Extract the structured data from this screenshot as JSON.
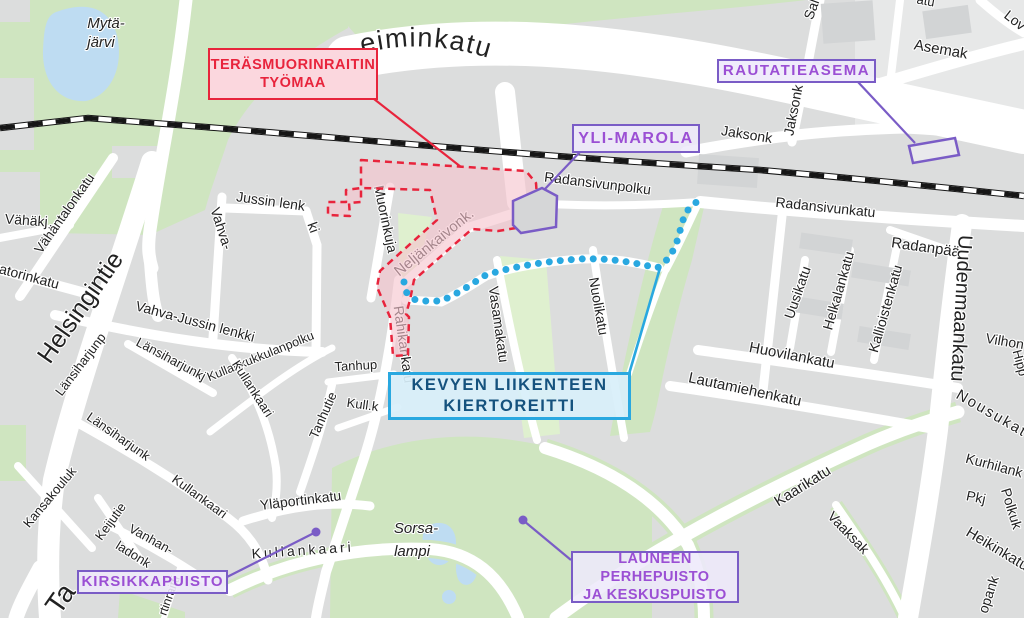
{
  "main_road_label": "Mannerheiminkatu",
  "annotations": {
    "work_area": {
      "lines": [
        "TERÄSMUORINRAITIN",
        "TYÖMAA"
      ],
      "color": "#e8243c"
    },
    "detour": {
      "lines": [
        "KEVYEN LIIKENTEEN",
        "KIERTOREITTI"
      ],
      "border": "#29a8e0",
      "text_color": "#15527e"
    },
    "rautatieasema": {
      "label": "RAUTATIEASEMA"
    },
    "yli_marola": {
      "label": "YLI-MAROLA"
    },
    "kirsikkapuisto": {
      "label": "KIRSIKKAPUISTO"
    },
    "launeen": {
      "lines": [
        "LAUNEEN PERHEPUISTO",
        "JA KESKUSPUISTO"
      ]
    },
    "purple": "#7a5cc6",
    "purple_text": "#9b4fd4"
  },
  "colors": {
    "block_gray": "#dcdddd",
    "road_white": "#ffffff",
    "park_green": "#cfe5c0",
    "verge_green": "#dff0cf",
    "water_blue": "#bedcf2",
    "railway_black": "#161616",
    "work_area_fill": "#f6c3cd",
    "route_cyan": "#29a8e0"
  },
  "map_labels": [
    {
      "t": "Mytä-",
      "x": 106,
      "y": 28,
      "r": 0,
      "s": 15,
      "i": 1,
      "c": "#3f464d"
    },
    {
      "t": "järvi",
      "x": 101,
      "y": 47,
      "r": 0,
      "s": 15,
      "i": 1,
      "c": "#3f464d"
    },
    {
      "t": "Vähäkj",
      "x": 26,
      "y": 225,
      "r": 4,
      "s": 14
    },
    {
      "t": "Vähäntalonkatu",
      "x": 68,
      "y": 216,
      "r": -55,
      "s": 13.5
    },
    {
      "t": "atorinkatu",
      "x": 28,
      "y": 281,
      "r": 15,
      "s": 14
    },
    {
      "t": "Helsingintie",
      "x": 87,
      "y": 312,
      "r": -55,
      "s": 25
    },
    {
      "t": "Länsiharjunp",
      "x": 84,
      "y": 367,
      "r": -53,
      "s": 13
    },
    {
      "t": "Länsiharjunkj",
      "x": 169,
      "y": 363,
      "r": 28,
      "s": 13
    },
    {
      "t": "Vahva-Jussin lenkki",
      "x": 194,
      "y": 326,
      "r": 15,
      "s": 14
    },
    {
      "t": "Vahva-",
      "x": 217,
      "y": 230,
      "r": 72,
      "s": 14
    },
    {
      "t": "Jussin lenk",
      "x": 270,
      "y": 206,
      "r": 8,
      "s": 14
    },
    {
      "t": "ki",
      "x": 309,
      "y": 229,
      "r": 70,
      "s": 14
    },
    {
      "t": "Muorinkuja",
      "x": 381,
      "y": 220,
      "r": 78,
      "s": 14
    },
    {
      "t": "Neljänkaivonk.",
      "x": 437,
      "y": 246,
      "r": -39,
      "s": 15
    },
    {
      "t": "Rahikankatu",
      "x": 399,
      "y": 345,
      "r": 82,
      "s": 14
    },
    {
      "t": "Radansivunpolku",
      "x": 597,
      "y": 188,
      "r": 7,
      "s": 14
    },
    {
      "t": "Radansivunkatu",
      "x": 825,
      "y": 212,
      "r": 6,
      "s": 14
    },
    {
      "t": "Jaksonk",
      "x": 746,
      "y": 139,
      "r": 9,
      "s": 14
    },
    {
      "t": "Jaksonk",
      "x": 798,
      "y": 111,
      "r": -79,
      "s": 14
    },
    {
      "t": "Sal",
      "x": 816,
      "y": 11,
      "r": -70,
      "s": 14
    },
    {
      "t": "atu",
      "x": 925,
      "y": 5,
      "r": 10,
      "s": 13
    },
    {
      "t": "Asemak",
      "x": 940,
      "y": 54,
      "r": 10,
      "s": 15
    },
    {
      "t": "Lov",
      "x": 1012,
      "y": 24,
      "r": 38,
      "s": 14
    },
    {
      "t": "Radanpää",
      "x": 925,
      "y": 252,
      "r": 8,
      "s": 15
    },
    {
      "t": "Uusikatu",
      "x": 802,
      "y": 294,
      "r": -71,
      "s": 14
    },
    {
      "t": "Helkalankatu",
      "x": 843,
      "y": 292,
      "r": -74,
      "s": 14
    },
    {
      "t": "Kallioistenkatu",
      "x": 890,
      "y": 310,
      "r": -74,
      "s": 14
    },
    {
      "t": "Uudenmaankatu",
      "x": 955,
      "y": 308,
      "r": 93,
      "s": 20
    },
    {
      "t": "Vilhon",
      "x": 1004,
      "y": 346,
      "r": 10,
      "s": 14
    },
    {
      "t": "Hipp",
      "x": 1016,
      "y": 364,
      "r": 75,
      "s": 13
    },
    {
      "t": "Huovilankatu",
      "x": 791,
      "y": 360,
      "r": 11,
      "s": 15
    },
    {
      "t": "Lautamiehenkatu",
      "x": 744,
      "y": 394,
      "r": 12,
      "s": 15
    },
    {
      "t": "Nousukatu",
      "x": 994,
      "y": 420,
      "r": 30,
      "s": 15,
      "ls": 2
    },
    {
      "t": "Kurhilank",
      "x": 993,
      "y": 470,
      "r": 15,
      "s": 14
    },
    {
      "t": "Pkj",
      "x": 975,
      "y": 502,
      "r": 12,
      "s": 14
    },
    {
      "t": "Polkuk",
      "x": 1007,
      "y": 510,
      "r": 73,
      "s": 14
    },
    {
      "t": "Heikinkatu",
      "x": 995,
      "y": 553,
      "r": 31,
      "s": 15
    },
    {
      "t": "opank",
      "x": 993,
      "y": 596,
      "r": -72,
      "s": 14
    },
    {
      "t": "Kaarikatu",
      "x": 805,
      "y": 490,
      "r": -32,
      "s": 15
    },
    {
      "t": "Vaaksak",
      "x": 845,
      "y": 536,
      "r": 46,
      "s": 14
    },
    {
      "t": "Tanhup",
      "x": 356,
      "y": 370,
      "r": -3,
      "s": 13
    },
    {
      "t": "Kull.k",
      "x": 362,
      "y": 409,
      "r": 8,
      "s": 13
    },
    {
      "t": "Tanhutie",
      "x": 327,
      "y": 417,
      "r": -66,
      "s": 13
    },
    {
      "t": "Kullankukkulanpolku",
      "x": 262,
      "y": 360,
      "r": -22,
      "s": 12.5
    },
    {
      "t": "Länsiharjunk",
      "x": 116,
      "y": 440,
      "r": 35,
      "s": 13
    },
    {
      "t": "Kansakouluk",
      "x": 53,
      "y": 500,
      "r": -50,
      "s": 13
    },
    {
      "t": "Kullankaari",
      "x": 197,
      "y": 500,
      "r": 36,
      "s": 13
    },
    {
      "t": "Kullankaari",
      "x": 249,
      "y": 391,
      "r": 57,
      "s": 13
    },
    {
      "t": "Keijutie",
      "x": 114,
      "y": 524,
      "r": -54,
      "s": 13
    },
    {
      "t": "Vanhan-",
      "x": 149,
      "y": 543,
      "r": 29,
      "s": 13
    },
    {
      "t": "ladonk",
      "x": 131,
      "y": 558,
      "r": 32,
      "s": 13
    },
    {
      "t": "Yläportinkatu",
      "x": 301,
      "y": 505,
      "r": -7,
      "s": 14
    },
    {
      "t": "Kullankaari",
      "x": 303,
      "y": 555,
      "r": -4,
      "s": 14,
      "ls": 3
    },
    {
      "t": "rtinraitti",
      "x": 173,
      "y": 597,
      "r": -70,
      "s": 12.5
    },
    {
      "t": "Ta",
      "x": 68,
      "y": 604,
      "r": -55,
      "s": 28
    },
    {
      "t": "Sorsa-",
      "x": 416,
      "y": 533,
      "r": 0,
      "s": 15,
      "i": 1,
      "c": "#3f464d"
    },
    {
      "t": "lampi",
      "x": 412,
      "y": 556,
      "r": 0,
      "s": 15,
      "i": 1,
      "c": "#3f464d"
    },
    {
      "t": "Vasamakatu",
      "x": 494,
      "y": 325,
      "r": 82,
      "s": 14
    },
    {
      "t": "Nuolikatu",
      "x": 594,
      "y": 307,
      "r": 80,
      "s": 14
    }
  ]
}
